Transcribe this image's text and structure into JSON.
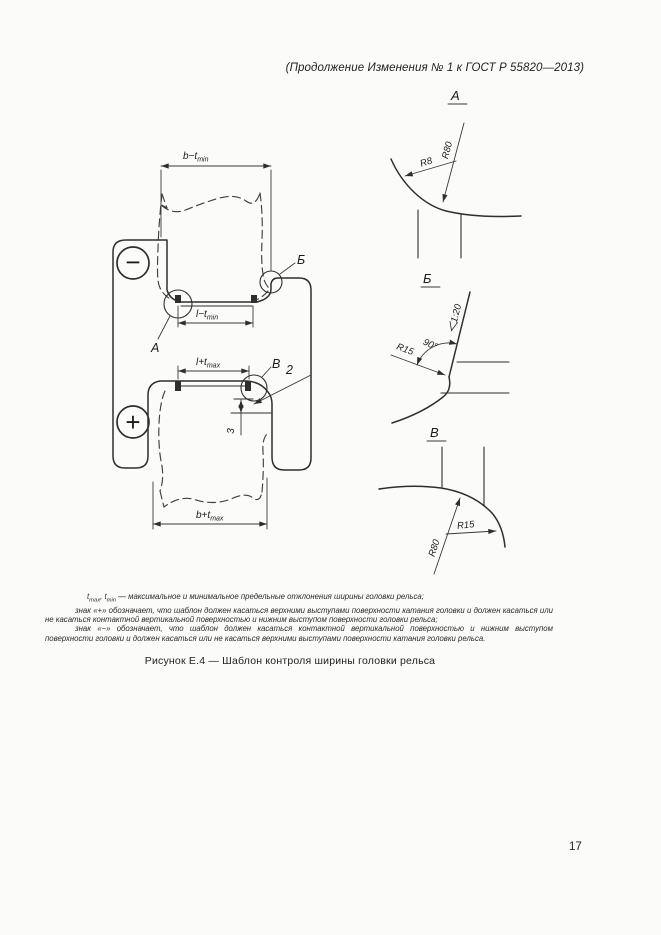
{
  "page": {
    "header": "(Продолжение Изменения № 1 к ГОСТ Р 55820—2013)",
    "caption": "Рисунок Е.4 — Шаблон контроля ширины головки рельса",
    "page_number": "17"
  },
  "figure": {
    "dims": {
      "top_main": "b−t",
      "top_sub": "min",
      "mouth_min_main": "l−t",
      "mouth_min_sub": "min",
      "mouth_max_main": "l+t",
      "mouth_max_sub": "max",
      "bottom_main": "b+t",
      "bottom_sub": "max"
    },
    "symbols": {
      "minus": "−",
      "plus": "+"
    },
    "details": {
      "a": "А",
      "b": "Б",
      "v": "В"
    },
    "callouts": {
      "two": "2",
      "three": "3"
    },
    "views": {
      "a": {
        "title": "А",
        "r80": "R80",
        "r8": "R8"
      },
      "b": {
        "title": "Б",
        "r15": "R15",
        "angle": "90°",
        "slope": "1:20"
      },
      "v": {
        "title": "В",
        "r80": "R80",
        "r15": "R15"
      }
    }
  },
  "notes": {
    "line1": {
      "t1": "t",
      "t1sub": "max",
      "t2": ", t",
      "t2sub": "min",
      "rest": " — максимальное и минимальное предельные отклонения ширины головки рельса;"
    },
    "line2": "знак «+» обозначает, что шаблон должен касаться верхними выступами поверхности катания головки и должен касаться или не касаться контактной вертикальной поверхностью и нижним выступом поверхности головки рельса;",
    "line3": "знак «−» обозначает, что шаблон должен касаться контактной вертикальной поверхностью и нижним выступом поверхности головки и должен касаться или не касаться верхними выступами поверхности катания головки рельса."
  }
}
